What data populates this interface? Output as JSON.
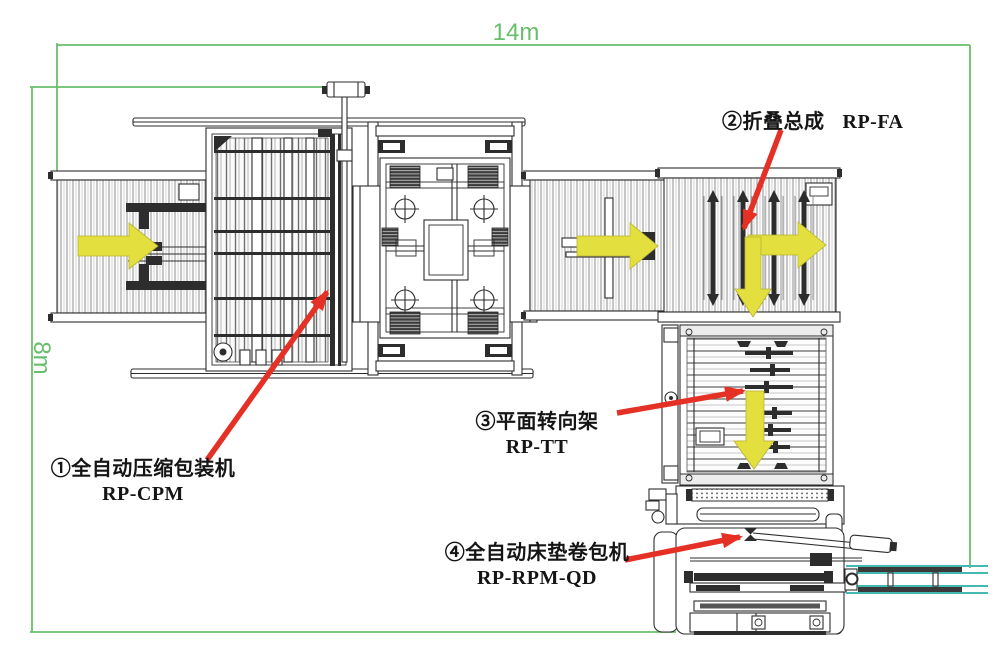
{
  "diagram": {
    "type": "equipment-layout-top-view",
    "dimension_width": "14m",
    "dimension_height": "8m"
  },
  "machines": {
    "m1": {
      "label": "①全自动压缩包装机",
      "model": "RP-CPM"
    },
    "m2": {
      "label": "②折叠总成",
      "model": "RP-FA"
    },
    "m3": {
      "label": "③平面转向架",
      "model": "RP-TT"
    },
    "m4": {
      "label": "④全自动床垫卷包机",
      "model": "RP-RPM-QD"
    }
  },
  "flow_arrows": {
    "count": 5,
    "directions": [
      "right-infeed",
      "right-middle",
      "right-folding",
      "down-folding",
      "down-turning-frame"
    ]
  },
  "colors": {
    "dimension_green": "#68bf6b",
    "flow_arrow_yellow": "#e3df3e",
    "annotation_red": "#e53125",
    "exit_conveyor_teal": "#45b8b2",
    "line_dark": "#2d2d2d"
  }
}
